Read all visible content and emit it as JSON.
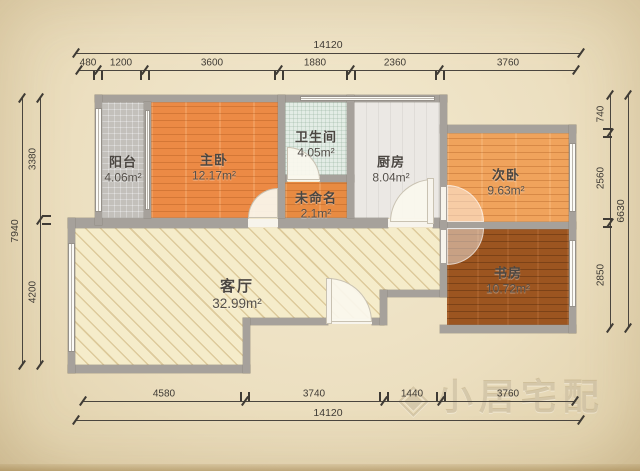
{
  "plan": {
    "title": "apartment-floor-plan",
    "rooms": [
      {
        "id": "balcony",
        "name": "阳台",
        "area": "4.06m²"
      },
      {
        "id": "master-bedroom",
        "name": "主卧",
        "area": "12.17m²"
      },
      {
        "id": "bathroom",
        "name": "卫生间",
        "area": "4.05m²"
      },
      {
        "id": "unnamed",
        "name": "未命名",
        "area": "2.1m²"
      },
      {
        "id": "kitchen",
        "name": "厨房",
        "area": "8.04m²"
      },
      {
        "id": "second-bedroom",
        "name": "次卧",
        "area": "9.63m²"
      },
      {
        "id": "study",
        "name": "书房",
        "area": "10.72m²"
      },
      {
        "id": "living-room",
        "name": "客厅",
        "area": "32.99m²"
      }
    ],
    "dimensions": {
      "top": {
        "overall": "14120",
        "segments": [
          "480",
          "1200",
          "3600",
          "1880",
          "2360",
          "3760"
        ]
      },
      "bottom": {
        "overall": "14120",
        "segments": [
          "4580",
          "3740",
          "1440",
          "3760"
        ]
      },
      "left": {
        "overall": "7940",
        "segments": [
          "3380",
          "4200"
        ]
      },
      "right": {
        "overall": "6630",
        "segments": [
          "740",
          "2560",
          "2850"
        ]
      }
    },
    "watermark": {
      "icon": "◈",
      "text": "小居宅配"
    },
    "colors": {
      "wall": "#a6a19b",
      "dimension": "#3f3b35",
      "floor_balcony": "#c3c0bb",
      "floor_master": "#ec8a45",
      "floor_bathroom": "#e3ece5",
      "floor_unnamed": "#e88b42",
      "floor_kitchen": "#ebe8e4",
      "floor_second": "#f0a35c",
      "floor_study": "#9c5520",
      "floor_living": "#f5ecca"
    }
  }
}
